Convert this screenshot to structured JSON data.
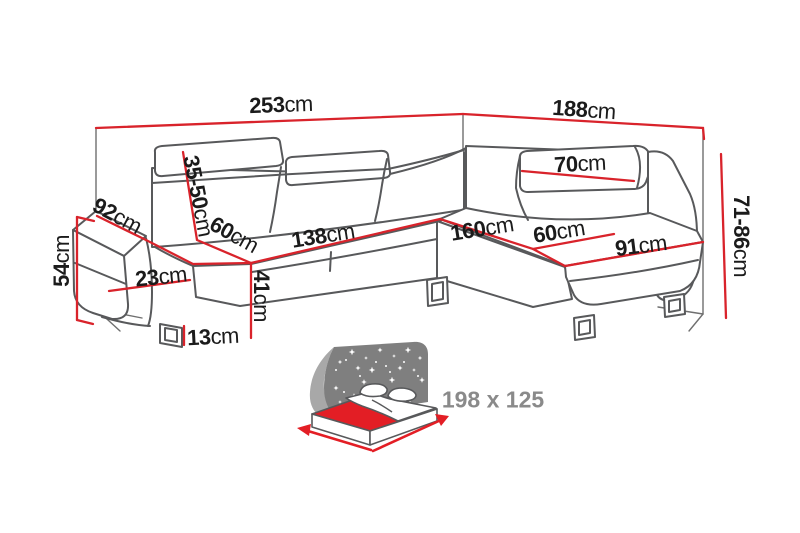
{
  "drawing": {
    "description": "corner sofa dimension diagram",
    "unit_suffix": "cm",
    "colors": {
      "dimension_red": "#d9232b",
      "outline_gray": "#58595b",
      "wall_gray": "#6f6f6f",
      "bed_panel_gray": "#7f7f7f",
      "bed_swoosh_gray": "#a8a8a8",
      "bed_mattress_red": "#e31e25",
      "bed_text_gray": "#8a8a8a",
      "label_black": "#1b1b1b"
    },
    "dims": {
      "total_width": {
        "value": "253",
        "unit": "cm"
      },
      "total_depth": {
        "value": "188",
        "unit": "cm"
      },
      "back_height": {
        "value": "71-86",
        "unit": "cm"
      },
      "arm_height": {
        "value": "54",
        "unit": "cm"
      },
      "arm_top_width": {
        "value": "92",
        "unit": "cm"
      },
      "headrest_range": {
        "value": "35-50",
        "unit": "cm"
      },
      "seat_depth_left": {
        "value": "60",
        "unit": "cm"
      },
      "seat_width_left": {
        "value": "138",
        "unit": "cm"
      },
      "arm_front_width": {
        "value": "23",
        "unit": "cm"
      },
      "seat_height": {
        "value": "41",
        "unit": "cm"
      },
      "leg_height": {
        "value": "13",
        "unit": "cm"
      },
      "chaise_length": {
        "value": "160",
        "unit": "cm"
      },
      "seat_depth_right": {
        "value": "60",
        "unit": "cm"
      },
      "chaise_front": {
        "value": "91",
        "unit": "cm"
      },
      "headrest_width": {
        "value": "70",
        "unit": "cm"
      }
    },
    "sleeping_area": {
      "label": "198 x 125"
    }
  }
}
